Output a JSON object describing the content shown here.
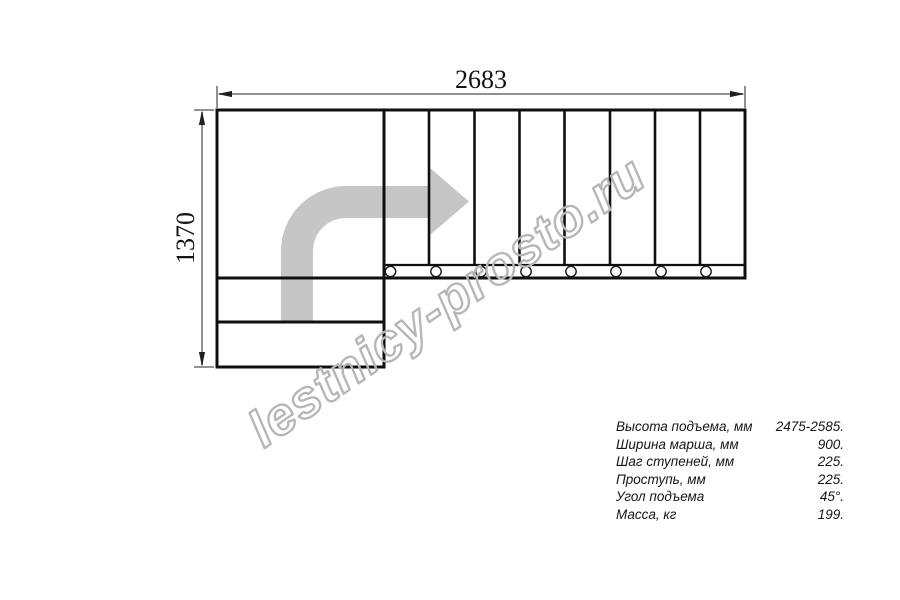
{
  "drawing": {
    "title": "staircase-plan-view",
    "width_dimension_label": "2683",
    "height_dimension_label": "1370",
    "watermark_text": "lestnicy-prosto.ru",
    "top_flight_treads": 8,
    "lower_flight_treads": 2,
    "colors": {
      "outline": "#0f0f0f",
      "dimension_line": "#919191",
      "dimension_arrow": "#1f1f1f",
      "direction_arrow_fill": "#c6c6c6",
      "watermark_stroke": "#b6b6b6"
    }
  },
  "specs": {
    "rows": [
      {
        "label": "Высота подъема, мм",
        "value": "2475-2585."
      },
      {
        "label": "Ширина марша, мм",
        "value": "900."
      },
      {
        "label": "Шаг ступеней, мм",
        "value": "225."
      },
      {
        "label": "Проступь, мм",
        "value": "225."
      },
      {
        "label": "Угол подъема",
        "value": "45°."
      },
      {
        "label": "Масса, кг",
        "value": "199."
      }
    ]
  }
}
